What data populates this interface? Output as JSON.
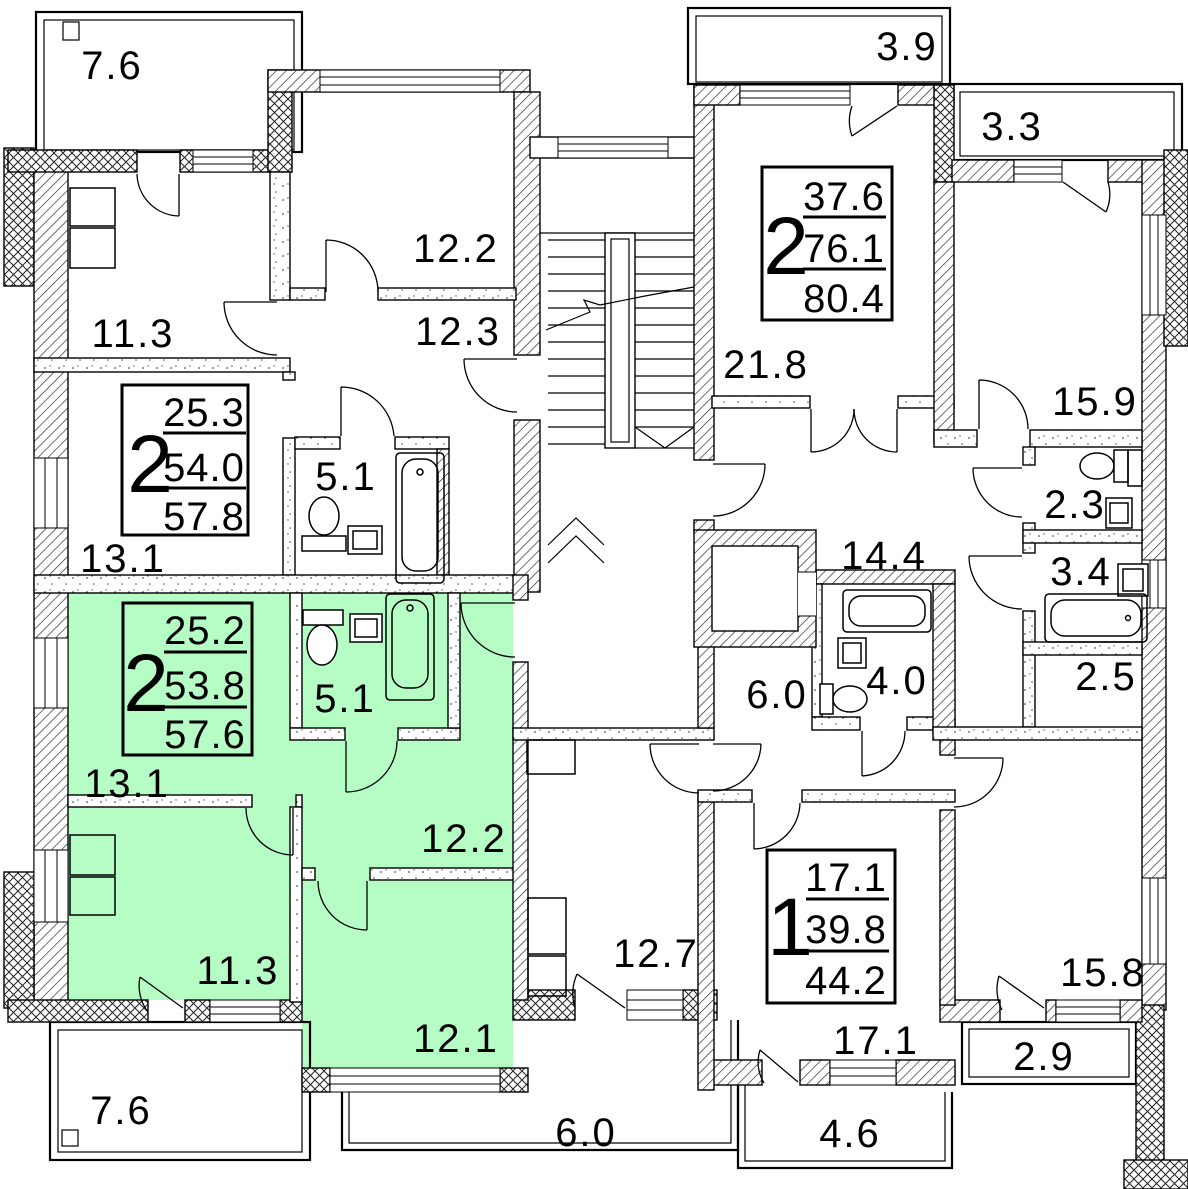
{
  "plan": {
    "title": "apartment-floor-plan",
    "highlight_color": "#b6fdc5",
    "wall_color": "#000000",
    "rooms": {
      "balcony_top_left": "7.6",
      "kitchen_upper_left": "11.3",
      "room_upper_12_2": "12.2",
      "corridor_upper_12_3": "12.3",
      "bath_upper_5_1": "5.1",
      "hall_upper_13_1": "13.1",
      "hall_green_13_1": "13.1",
      "bath_green_5_1": "5.1",
      "room_green_12_2": "12.2",
      "kitchen_green_11_3": "11.3",
      "room_green_12_1": "12.1",
      "balcony_bottom_left": "7.6",
      "balcony_bottom_center": "6.0",
      "balcony_bottom_mid": "4.6",
      "balcony_bottom_right": "2.9",
      "balcony_top_right": "3.9",
      "balcony_top_right_corner": "3.3",
      "living_21_8": "21.8",
      "room_15_9": "15.9",
      "wc_2_3": "2.3",
      "bath_3_4": "3.4",
      "corridor_14_4": "14.4",
      "storage_2_5": "2.5",
      "hall_6_0": "6.0",
      "bath_4_0": "4.0",
      "room_17_1": "17.1",
      "kitchen_12_7": "12.7",
      "room_15_8": "15.8"
    },
    "apartments": [
      {
        "type": "2",
        "living": "25.3",
        "area": "54.0",
        "total": "57.8"
      },
      {
        "type": "2",
        "living": "25.2",
        "area": "53.8",
        "total": "57.6"
      },
      {
        "type": "2",
        "living": "37.6",
        "area": "76.1",
        "total": "80.4"
      },
      {
        "type": "1",
        "living": "17.1",
        "area": "39.8",
        "total": "44.2"
      }
    ]
  }
}
